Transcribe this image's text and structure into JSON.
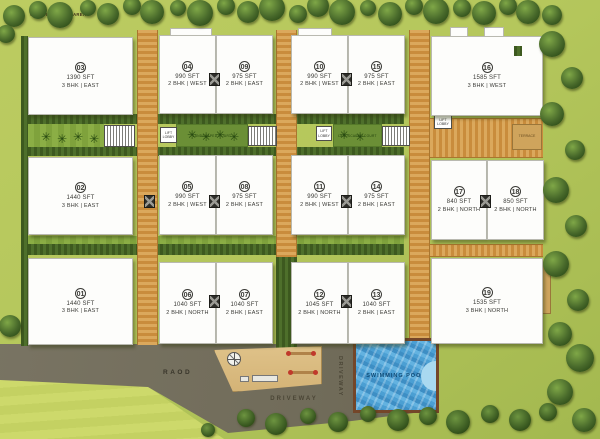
{
  "units": [
    {
      "no": "01",
      "sft": "1440 SFT",
      "facing": "3 BHK | EAST",
      "x": 28,
      "y": 258,
      "w": 105,
      "h": 87
    },
    {
      "no": "02",
      "sft": "1440 SFT",
      "facing": "3 BHK | EAST",
      "x": 28,
      "y": 157,
      "w": 105,
      "h": 78
    },
    {
      "no": "03",
      "sft": "1390 SFT",
      "facing": "3 BHK | EAST",
      "x": 28,
      "y": 37,
      "w": 105,
      "h": 78
    },
    {
      "no": "04",
      "sft": "990 SFT",
      "facing": "2 BHK | WEST",
      "x": 159,
      "y": 35,
      "w": 57,
      "h": 79
    },
    {
      "no": "05",
      "sft": "990 SFT",
      "facing": "2 BHK | WEST",
      "x": 159,
      "y": 155,
      "w": 57,
      "h": 80
    },
    {
      "no": "06",
      "sft": "1040 SFT",
      "facing": "2 BHK | NORTH",
      "x": 159,
      "y": 262,
      "w": 57,
      "h": 82
    },
    {
      "no": "07",
      "sft": "1040 SFT",
      "facing": "2 BHK | EAST",
      "x": 216,
      "y": 262,
      "w": 57,
      "h": 82
    },
    {
      "no": "08",
      "sft": "975 SFT",
      "facing": "2 BHK | EAST",
      "x": 216,
      "y": 155,
      "w": 57,
      "h": 80
    },
    {
      "no": "09",
      "sft": "975 SFT",
      "facing": "2 BHK | EAST",
      "x": 216,
      "y": 35,
      "w": 57,
      "h": 79
    },
    {
      "no": "10",
      "sft": "990 SFT",
      "facing": "2 BHK | WEST",
      "x": 291,
      "y": 35,
      "w": 57,
      "h": 79
    },
    {
      "no": "11",
      "sft": "990 SFT",
      "facing": "2 BHK | WEST",
      "x": 291,
      "y": 155,
      "w": 57,
      "h": 80
    },
    {
      "no": "12",
      "sft": "1045 SFT",
      "facing": "2 BHK | NORTH",
      "x": 291,
      "y": 262,
      "w": 57,
      "h": 82
    },
    {
      "no": "13",
      "sft": "1040 SFT",
      "facing": "2 BHK | EAST",
      "x": 348,
      "y": 262,
      "w": 57,
      "h": 82
    },
    {
      "no": "14",
      "sft": "975 SFT",
      "facing": "2 BHK | EAST",
      "x": 348,
      "y": 155,
      "w": 57,
      "h": 80
    },
    {
      "no": "15",
      "sft": "975 SFT",
      "facing": "2 BHK | EAST",
      "x": 348,
      "y": 35,
      "w": 57,
      "h": 79
    },
    {
      "no": "16",
      "sft": "1585 SFT",
      "facing": "3 BHK | WEST",
      "x": 431,
      "y": 36,
      "w": 112,
      "h": 80
    },
    {
      "no": "17",
      "sft": "840 SFT",
      "facing": "2 BHK | NORTH",
      "x": 431,
      "y": 160,
      "w": 56,
      "h": 80
    },
    {
      "no": "18",
      "sft": "850 SFT",
      "facing": "2 BHK | NORTH",
      "x": 487,
      "y": 160,
      "w": 57,
      "h": 80
    },
    {
      "no": "19",
      "sft": "1535 SFT",
      "facing": "3 BHK | NORTH",
      "x": 431,
      "y": 258,
      "w": 112,
      "h": 86
    }
  ],
  "labels": {
    "road": "RAOD",
    "driveway": "DRIVEWAY",
    "swimming_pool": "SWIMMING POOL",
    "play_area": "CHILDREN'S PLAY AREA",
    "terrace": "TERRACE",
    "lift_lobby": "LIFT LOBBY",
    "landscaped_court": "LANDSCAPED COURT"
  },
  "colors": {
    "grass": "#b5c75c",
    "field": "#cdd96b",
    "road": "#716c5a",
    "walkway": "#c98c3c",
    "hedge": "#4e6f2b",
    "sand": "#d4b376",
    "pool_water": "#3d8ec4",
    "pool_border": "#744629",
    "building": "#fdfdfb"
  }
}
